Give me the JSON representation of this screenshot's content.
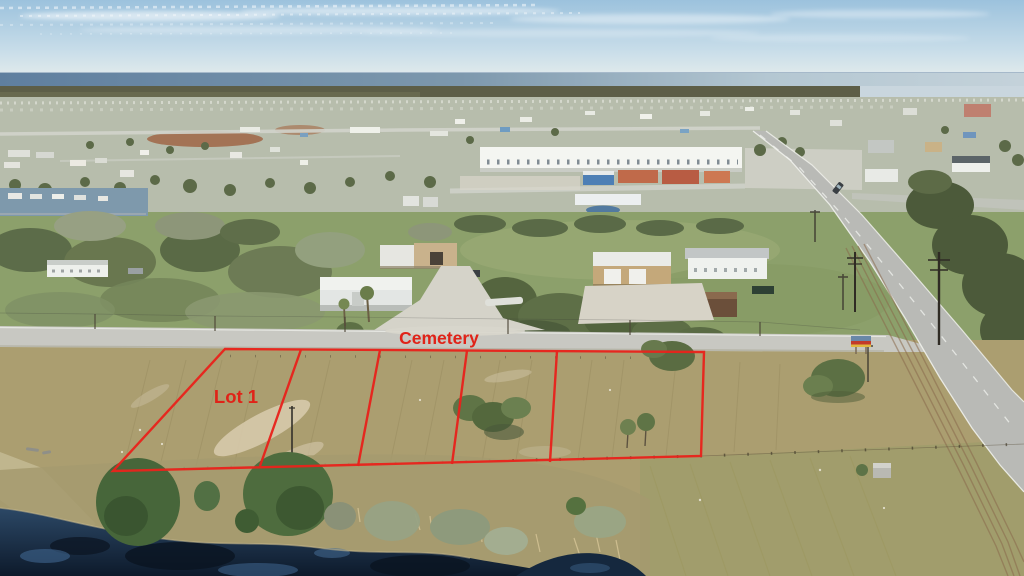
{
  "annotation": {
    "road_label": "Cemetery",
    "lot_label": "Lot 1",
    "outline_color": "#e8231c",
    "label_color": "#e02318"
  },
  "palette": {
    "sky": "#a8cadf",
    "sea": "#6889a8",
    "town": "#b7bdac",
    "grass_mid": "#8ca06b",
    "field": "#ab9e70",
    "road": "#c8c8c2",
    "highway": "#b9bab6",
    "pond": "#13223a",
    "pine": "#4a683c"
  }
}
